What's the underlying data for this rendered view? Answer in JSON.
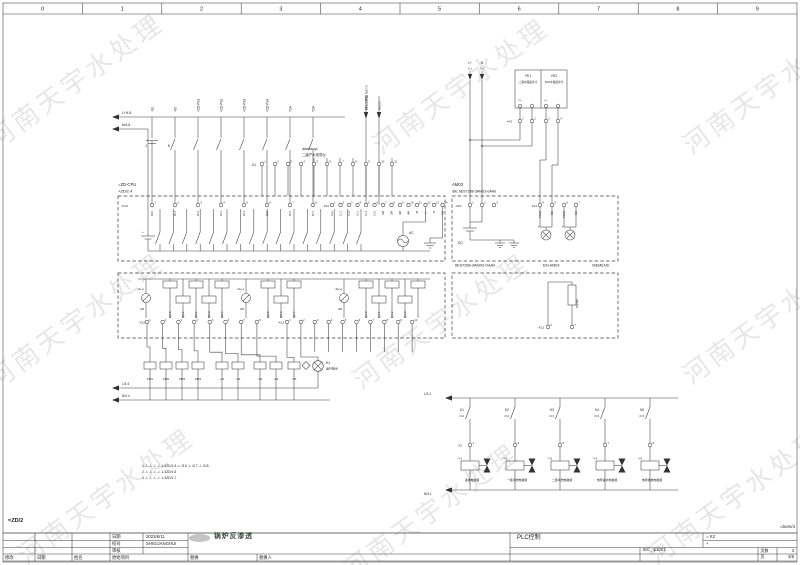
{
  "watermark": {
    "text": "河南天宇水处理"
  },
  "ruler": {
    "cols": [
      "0",
      "1",
      "2",
      "3",
      "4",
      "5",
      "6",
      "7",
      "8",
      "9"
    ]
  },
  "rails": {
    "top_l": "L+/4.8",
    "top_m": "M/4.8",
    "mid_l": "L/4.4",
    "mid_n": "N/4.4"
  },
  "top_devices": {
    "labels": [
      "-S1",
      "-K0",
      "<ZD-PS1",
      "<ZD-PS2",
      "<ZD-PS3",
      "<ZD-PS4",
      "T1A",
      "T2A"
    ],
    "j_label": "J",
    "k_label": "K",
    "ref_out_1": "网头交换器 NO/T3",
    "ref_out_2": "NO/Z3",
    "conductivity_tag": "diandaoyi",
    "conductivity_desc": "二级产水电导仪"
  },
  "x1": {
    "label": "-X1",
    "terminals": [
      "1",
      "2",
      "3",
      "4",
      "5",
      "6",
      "7",
      "8",
      "9",
      "10",
      "11"
    ]
  },
  "cpu": {
    "tag": "=ZD-CPU",
    "loc": "+ZD/2.4",
    "x10": {
      "label": "-X10",
      "terminals": [
        "1",
        "2",
        "3",
        "4",
        "5",
        "6",
        "7",
        "8"
      ],
      "signals": [
        "I0.0",
        "I0.1",
        "I0.2",
        "I0.3",
        "I0.4",
        "I0.5",
        "I0.6",
        "I0.7"
      ]
    },
    "x11": {
      "label": "-X11",
      "terminals": [
        "1",
        "2",
        "3",
        "4",
        "5",
        "6",
        "7",
        "8",
        "9",
        "10",
        "11",
        "12",
        "13",
        "14"
      ],
      "signals": [
        "I1.0",
        "I1.1",
        "I1.2",
        "I1.3",
        "I1.4",
        "I1.5",
        "1M",
        "2M",
        "3M",
        "4M",
        "M",
        "L+",
        "N",
        "PE"
      ]
    },
    "ac": "AC",
    "plus": "+"
  },
  "am03": {
    "tag": "AM03",
    "model": "SIE 6ES7288-3AM03-0AA0",
    "x10": {
      "label": "-X10",
      "terminals": [
        "1",
        "2",
        "3"
      ]
    },
    "x11": {
      "label": "-X11",
      "terminals": [
        "4",
        "5",
        "6",
        "7"
      ],
      "signals": [
        "PIW0",
        "M0",
        "PIW2",
        "M2"
      ]
    },
    "dc": "DC",
    "plus1": "+",
    "plus2": "+",
    "caption_model": "6ES7288-3AM03-OAA0",
    "caption_name": "EM AM03",
    "caption_brand": "SIEMENS"
  },
  "outputs": {
    "x12": {
      "label": "-X12",
      "terminals": [
        "1",
        "2",
        "3",
        "4",
        "5",
        "6",
        "7",
        "8"
      ]
    },
    "x13": {
      "label": "-X13",
      "terminals": [
        "1",
        "2",
        "3",
        "4",
        "5",
        "6",
        "7",
        "8",
        "9",
        "10"
      ]
    },
    "q_labels": [
      "Q0.0",
      "Q0.1",
      "Q0.2",
      "Q0.3",
      "Q0.4",
      "Q0.5",
      "Q0.6",
      "Q0.7",
      "Q1.0",
      "Q1.1",
      "Q1.2",
      "Q1.3"
    ],
    "feeds_top": [
      "1L(+)",
      "2L(+)",
      "3L(+)"
    ],
    "feeds_bottom": [
      "1M",
      "2M",
      "3M"
    ]
  },
  "pqw": {
    "x_label": "-X12",
    "terminals": [
      "6",
      "7"
    ],
    "signal": "PQW0"
  },
  "contactors": {
    "coils": [
      "KM1",
      "KM2",
      "KM3",
      "KM4",
      "-K1",
      "-K2",
      "-K3",
      "-K4",
      "-K5"
    ],
    "lamp_tag": "H1",
    "lamp_desc": "运行指示"
  },
  "instruments": {
    "l_tag": "L+",
    "l_ref": "3.1",
    "m_tag": "M",
    "m_ref": "3.1",
    "ye1_tag": "YE1",
    "ye1_desc": "二级水箱液位计",
    "ye2_tag": "YE2",
    "ye2_desc": "RO1水箱液位计",
    "signs": [
      "L+",
      "-",
      "L+",
      "-"
    ],
    "x3": {
      "label": "=X3",
      "terminals": [
        "1",
        "2",
        "3",
        "4"
      ]
    }
  },
  "ladder": {
    "l_label": "L/3.1",
    "n_label": "N/3.1",
    "x2_label": "-X2",
    "branches": [
      {
        "contact": "K1",
        "ref": "/3.2",
        "terminal": "1",
        "coil": "-Y1",
        "desc": "进水电磁阀"
      },
      {
        "contact": "K2",
        "ref": "/3.2",
        "terminal": "3",
        "coil": "-Y2",
        "desc": "一级冲洗电磁阀"
      },
      {
        "contact": "K3",
        "ref": "/3.3",
        "terminal": "5",
        "coil": "-Y3",
        "desc": "二级冲洗电磁阀"
      },
      {
        "contact": "K4",
        "ref": "/3.3",
        "terminal": "7",
        "coil": "-Y4",
        "desc": "电导进水电磁阀"
      },
      {
        "contact": "K5",
        "ref": "/3.3",
        "terminal": "9",
        "coil": "-Y5",
        "desc": "电导排放电磁阀"
      }
    ]
  },
  "notes": [
    "1  -/-  -/-  -/-  -/-  1.4ZD/1.5    -/-  /3.6    -/-  /3.7    -/-  /3.8",
    "2  -/-  -/-  -/-  -/-  1.4ZD/1.6",
    "3  -/-  -/-  -/-  -/-  1.4ZD/1.7"
  ],
  "titleblock": {
    "doc_left": "=ZD/2",
    "doc_right": "=bom/4",
    "date_label": "日期",
    "date": "2023/6/11",
    "check_label": "校对",
    "check": "SHIGUANGHUI",
    "audit_label": "审核",
    "orig_label": "原始项目",
    "modify_label": "修改",
    "mdate_label": "日期",
    "name_label": "姓名",
    "replace_label": "替换",
    "replaceby_label": "替换人",
    "title": "锅炉反渗透",
    "function": "PLC控制",
    "plant": "= K2",
    "plus": "+",
    "form": "IEC_tp1001",
    "pages_label": "页数",
    "pages": "3",
    "page_label": "页",
    "page": "3/5"
  }
}
